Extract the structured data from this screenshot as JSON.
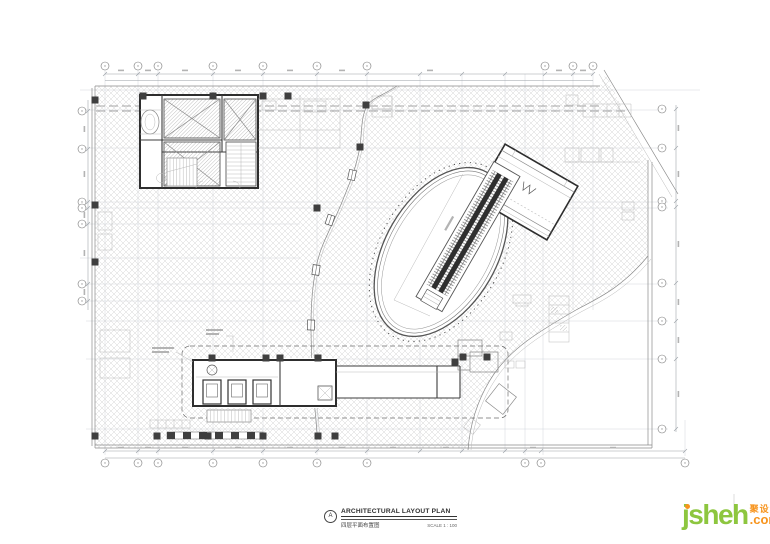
{
  "title_block": {
    "marker": "A",
    "title": "ARCHITECTURAL LAYOUT PLAN",
    "subtitle": "四层平面布置图",
    "scale": "SCALE 1 : 100"
  },
  "logo": {
    "brand": "jsheh",
    "suffix": ".com",
    "tagline": "聚设汇"
  },
  "colors": {
    "brand_green": "#8dc63f",
    "brand_orange": "#f7941d",
    "wall": "#2e2e2e",
    "grid": "#ccd1d9",
    "hatch": "#d6d6d6"
  }
}
